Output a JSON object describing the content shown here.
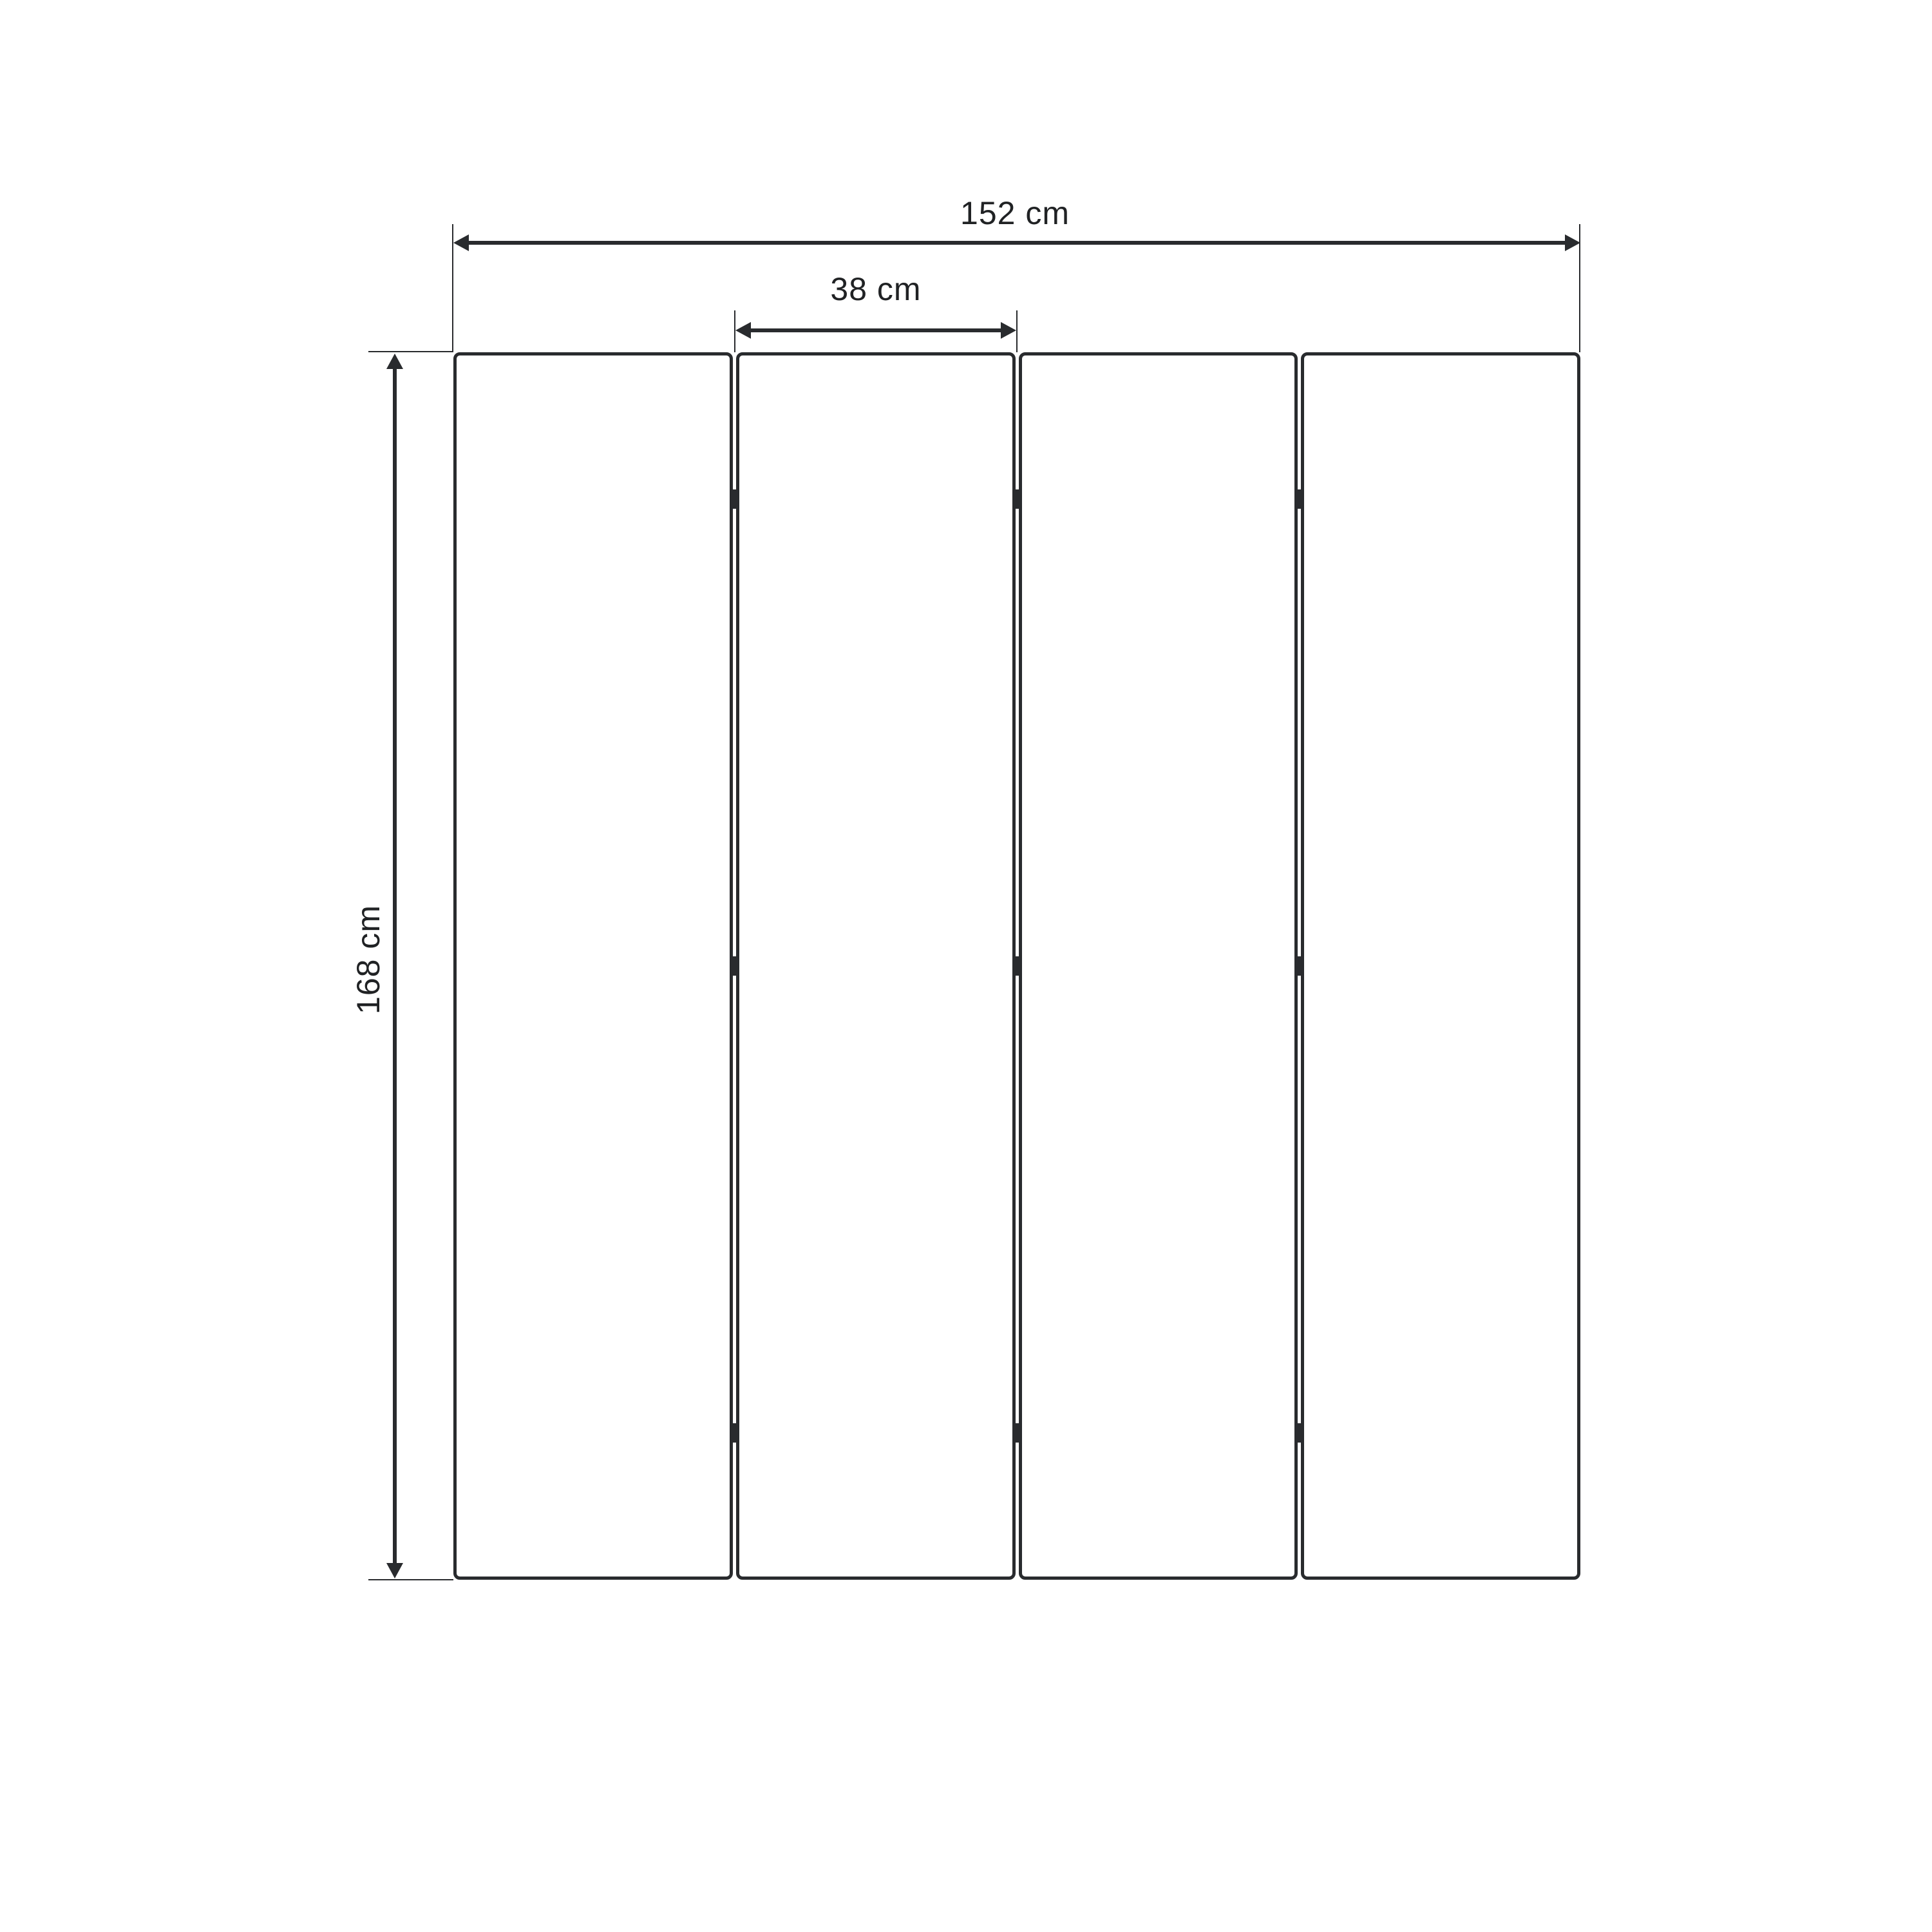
{
  "colors": {
    "background": "#ffffff",
    "line": "#292b2e",
    "text": "#202224"
  },
  "figure": {
    "type": "dimensioned-drawing",
    "subject": "four-panel folding screen, front elevation",
    "panel_count": 4,
    "hinge_rows_per_gap": 3
  },
  "dimensions": {
    "total_width": {
      "value": 152,
      "unit": "cm",
      "label": "152 cm"
    },
    "panel_width": {
      "value": 38,
      "unit": "cm",
      "label": "38 cm"
    },
    "height": {
      "value": 168,
      "unit": "cm",
      "label": "168 cm"
    }
  }
}
